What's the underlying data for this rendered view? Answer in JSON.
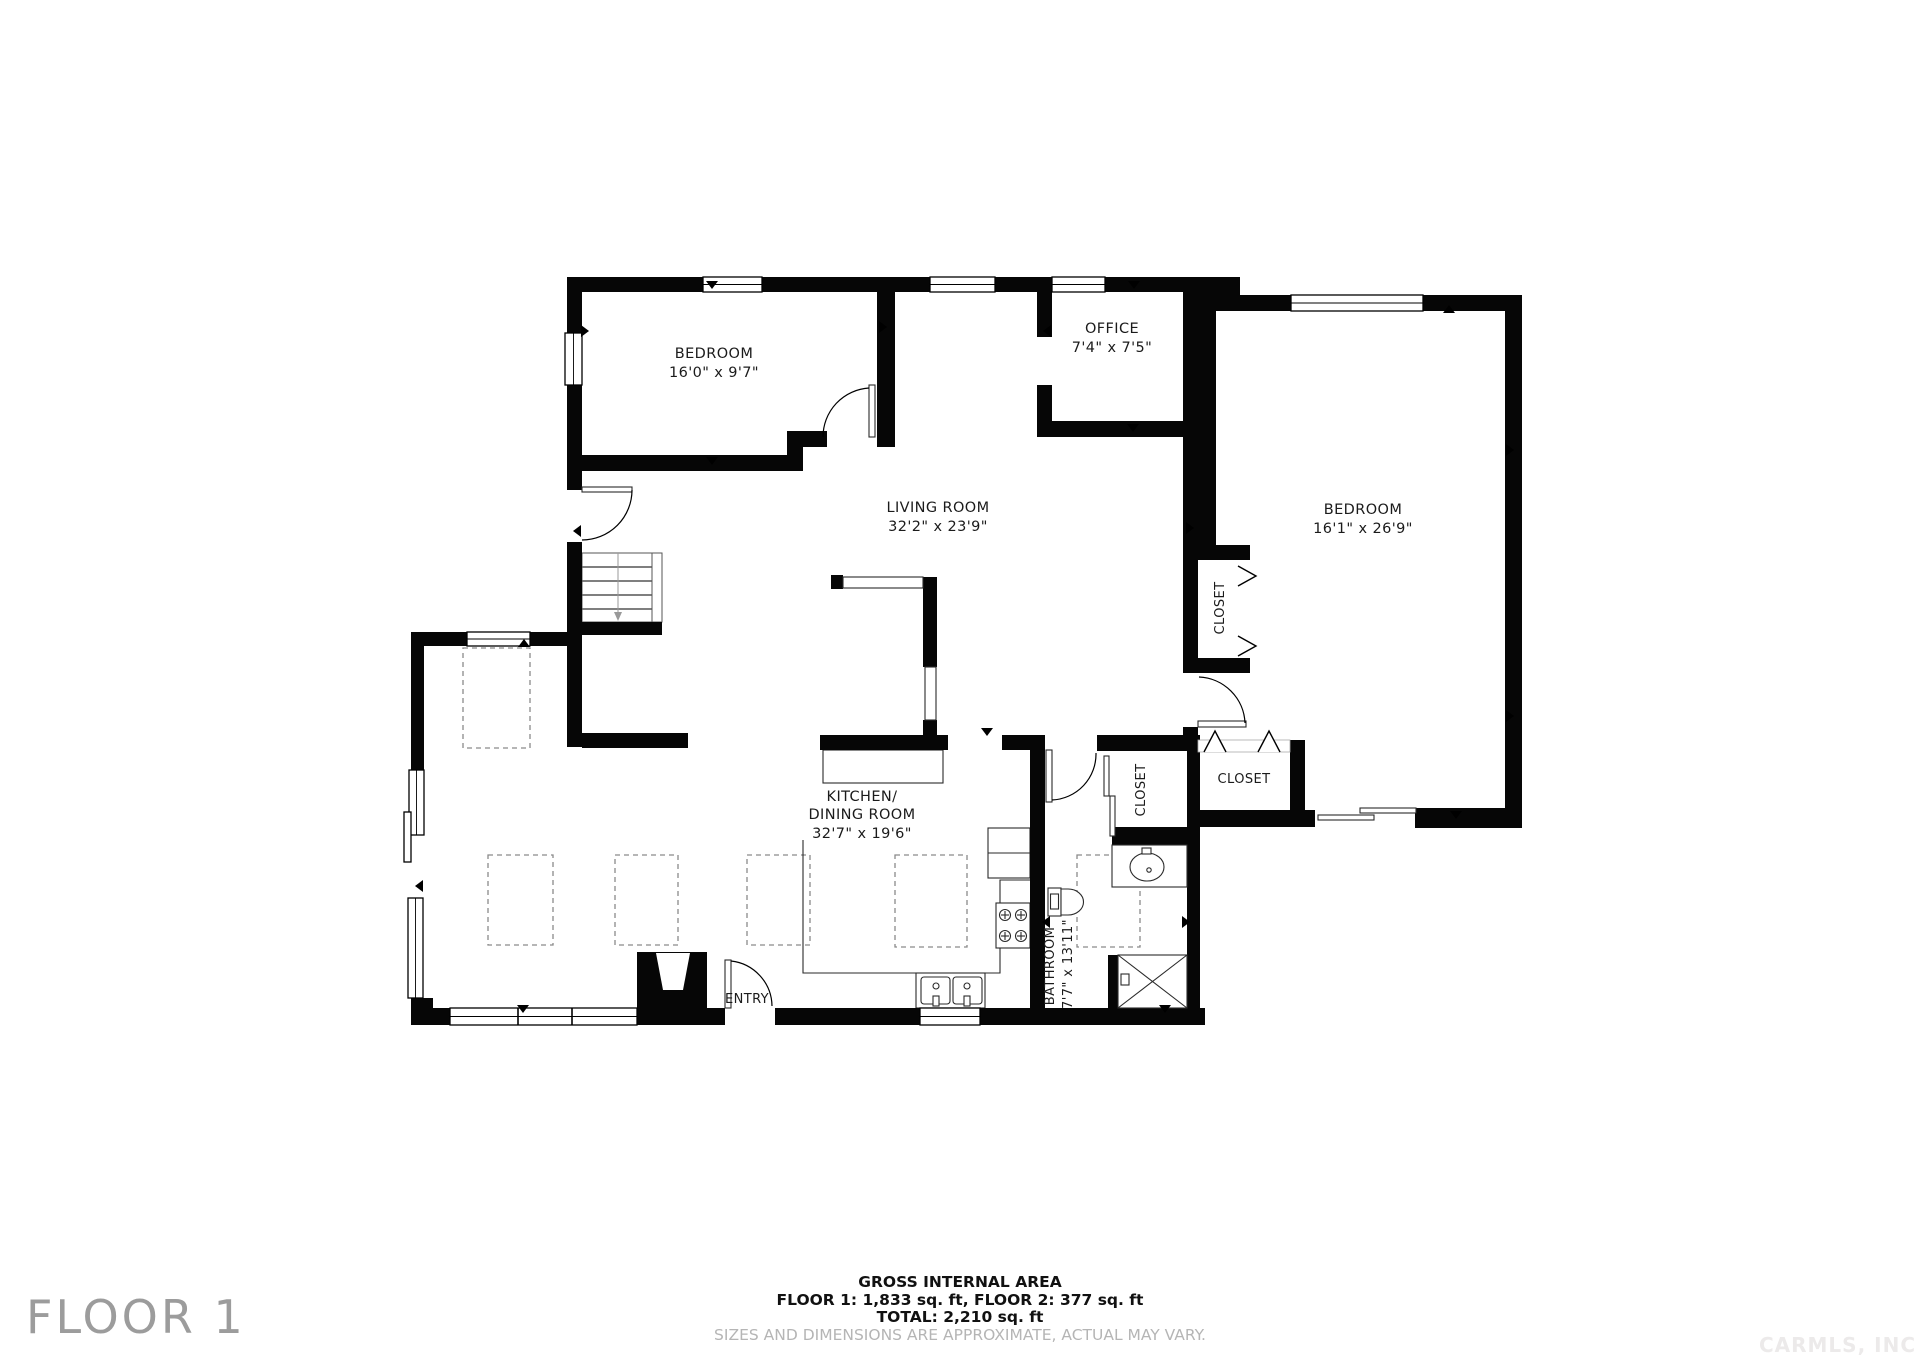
{
  "floor": {
    "big_label": "FLOOR 1"
  },
  "watermark": "CARMLS, INC",
  "footer": {
    "title": "GROSS INTERNAL AREA",
    "areas": "FLOOR 1: 1,833 sq. ft, FLOOR 2: 377 sq. ft",
    "total": "TOTAL: 2,210 sq. ft",
    "disclaimer": "SIZES AND DIMENSIONS ARE APPROXIMATE, ACTUAL MAY VARY."
  },
  "rooms": {
    "bedroom1": {
      "name": "BEDROOM",
      "dims": "16'0\" x 9'7\""
    },
    "office": {
      "name": "OFFICE",
      "dims": "7'4\" x 7'5\""
    },
    "living": {
      "name": "LIVING ROOM",
      "dims": "32'2\" x 23'9\""
    },
    "bedroom2": {
      "name": "BEDROOM",
      "dims": "16'1\" x 26'9\""
    },
    "kitchen": {
      "name_line1": "KITCHEN/",
      "name_line2": "DINING ROOM",
      "dims": "32'7\" x 19'6\""
    },
    "bathroom": {
      "name": "BATHROOM",
      "dims": "7'7\" x 13'11\""
    },
    "closet_upper": {
      "name": "CLOSET"
    },
    "closet_bedroom": {
      "name": "CLOSET"
    },
    "closet_bathroom": {
      "name": "CLOSET"
    },
    "entry": {
      "name": "ENTRY"
    }
  }
}
